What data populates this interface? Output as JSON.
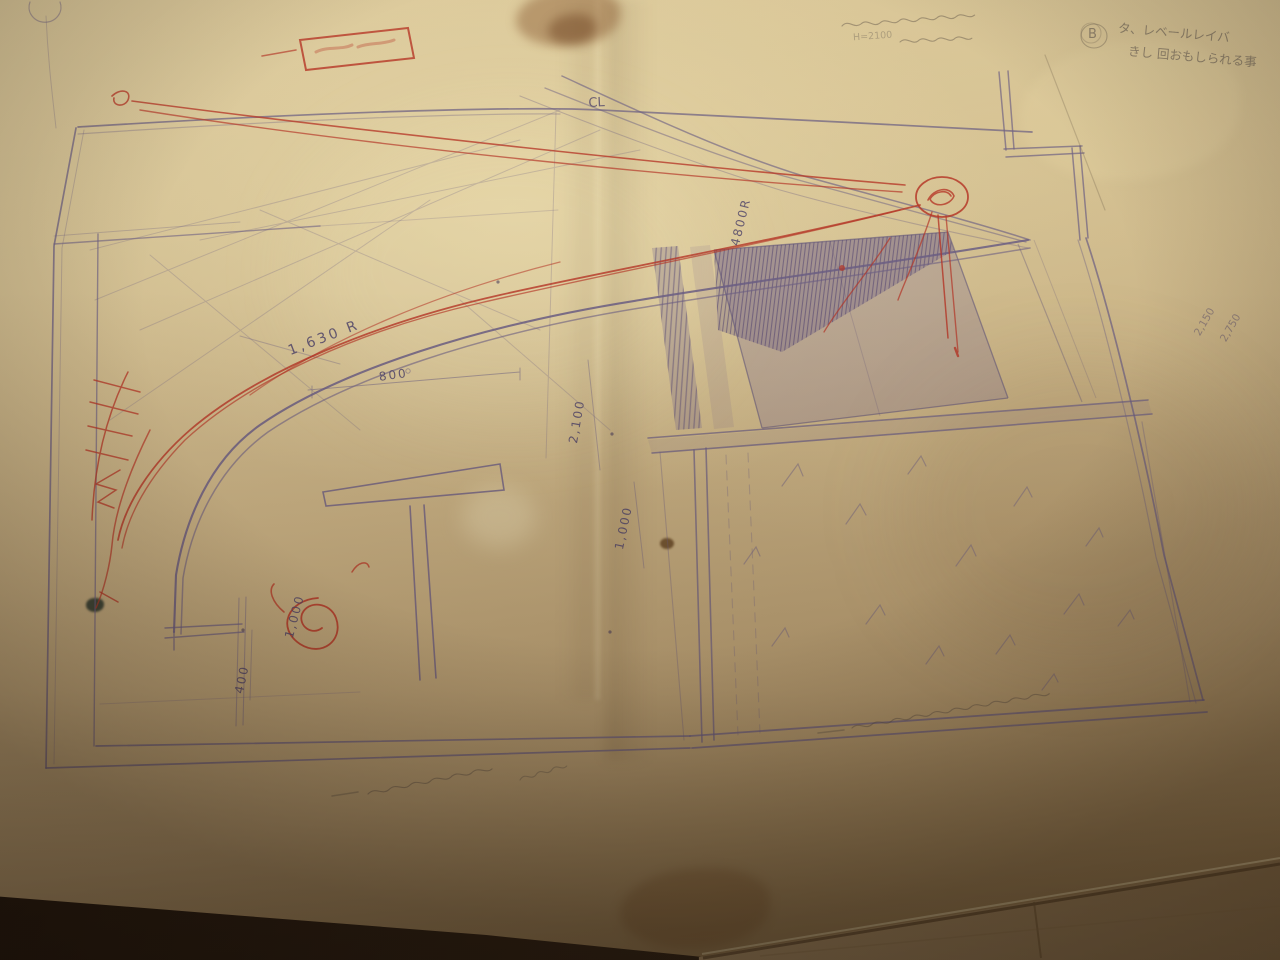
{
  "drawing": {
    "centerline": "CL",
    "dimensions": {
      "radius_4800": "4800R",
      "radius_1630": "1,630 R",
      "dim_800": "800",
      "dim_2100": "2,100",
      "dim_1000_right": "1,000",
      "dim_1000_left": "1,000",
      "dim_400": "400",
      "dim_2150": "2,150",
      "dim_2750": "2,750"
    },
    "handwritten_notes": {
      "top_right_mark": "B",
      "top_right_line1": "タ、レベールレイバ",
      "top_right_line2": "きし 回おもしられる事",
      "top_center_fragment": "H=2100"
    },
    "colors": {
      "ink_purple": "#6a5d82",
      "annotation_red": "#b43526",
      "paper_tan": "#cdb88c",
      "pencil_grey": "#6e6257"
    }
  }
}
